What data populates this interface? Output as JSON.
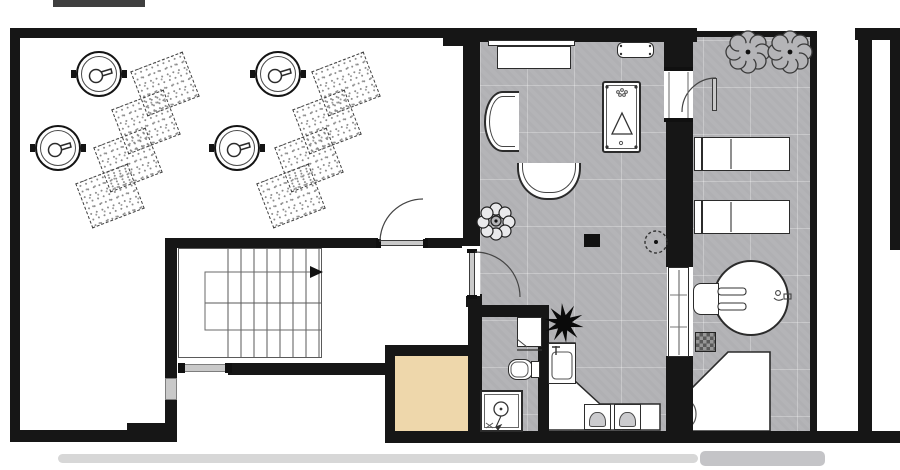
{
  "document": {
    "kind": "architectural floor plan",
    "style": "black walls on white background, gray tiled rooms, no text labels visible"
  },
  "palette": {
    "wall": "#161616",
    "outline": "#2b2b2b",
    "floor_gray": "#b4b4b7",
    "floor_white": "#ffffff",
    "sauna_wood": "#eed7ab",
    "window_gray": "#c9c9c9",
    "smudge": "#d7d7d7"
  },
  "rooms": [
    {
      "name": "large-hall-left",
      "floor": "white",
      "contents": "4 round ceiling fixtures, 8 dotted mats laid in two diagonal rows"
    },
    {
      "name": "stairwell",
      "floor": "white",
      "contents": "U-return staircase with direction arrow, exterior window below"
    },
    {
      "name": "sauna-block",
      "floor": "tan wood"
    },
    {
      "name": "lounge-games-room",
      "floor": "gray tile",
      "contents": "sideboard, wall bench, pool table, two curved sofas, plant, black side table, starburst ornament, washbasin counter with two chairs"
    },
    {
      "name": "shower-wc-room",
      "floor": "gray tile",
      "contents": "cabinet, toilet, shower tray"
    },
    {
      "name": "relax-room-right",
      "floor": "gray tile",
      "contents": "two plants, two loungers with side tables, round whirlpool with seat, stool, stepped platform"
    },
    {
      "name": "terrace-strip",
      "floor": "white"
    }
  ],
  "furniture_icons": [
    "ceiling-speaker-icon",
    "mat-dotted",
    "stairs-up-arrow",
    "door-swing-arc",
    "window-symbol",
    "sideboard",
    "wall-bench",
    "pool-table",
    "curved-sofa",
    "plant-flower",
    "plant-dashed",
    "starburst-ornament",
    "washbasin",
    "toilet",
    "shower-tray",
    "counter-l-shape",
    "chair",
    "lounger",
    "whirlpool-round",
    "stool-checkered",
    "platform-step",
    "sliding-door-panel"
  ]
}
